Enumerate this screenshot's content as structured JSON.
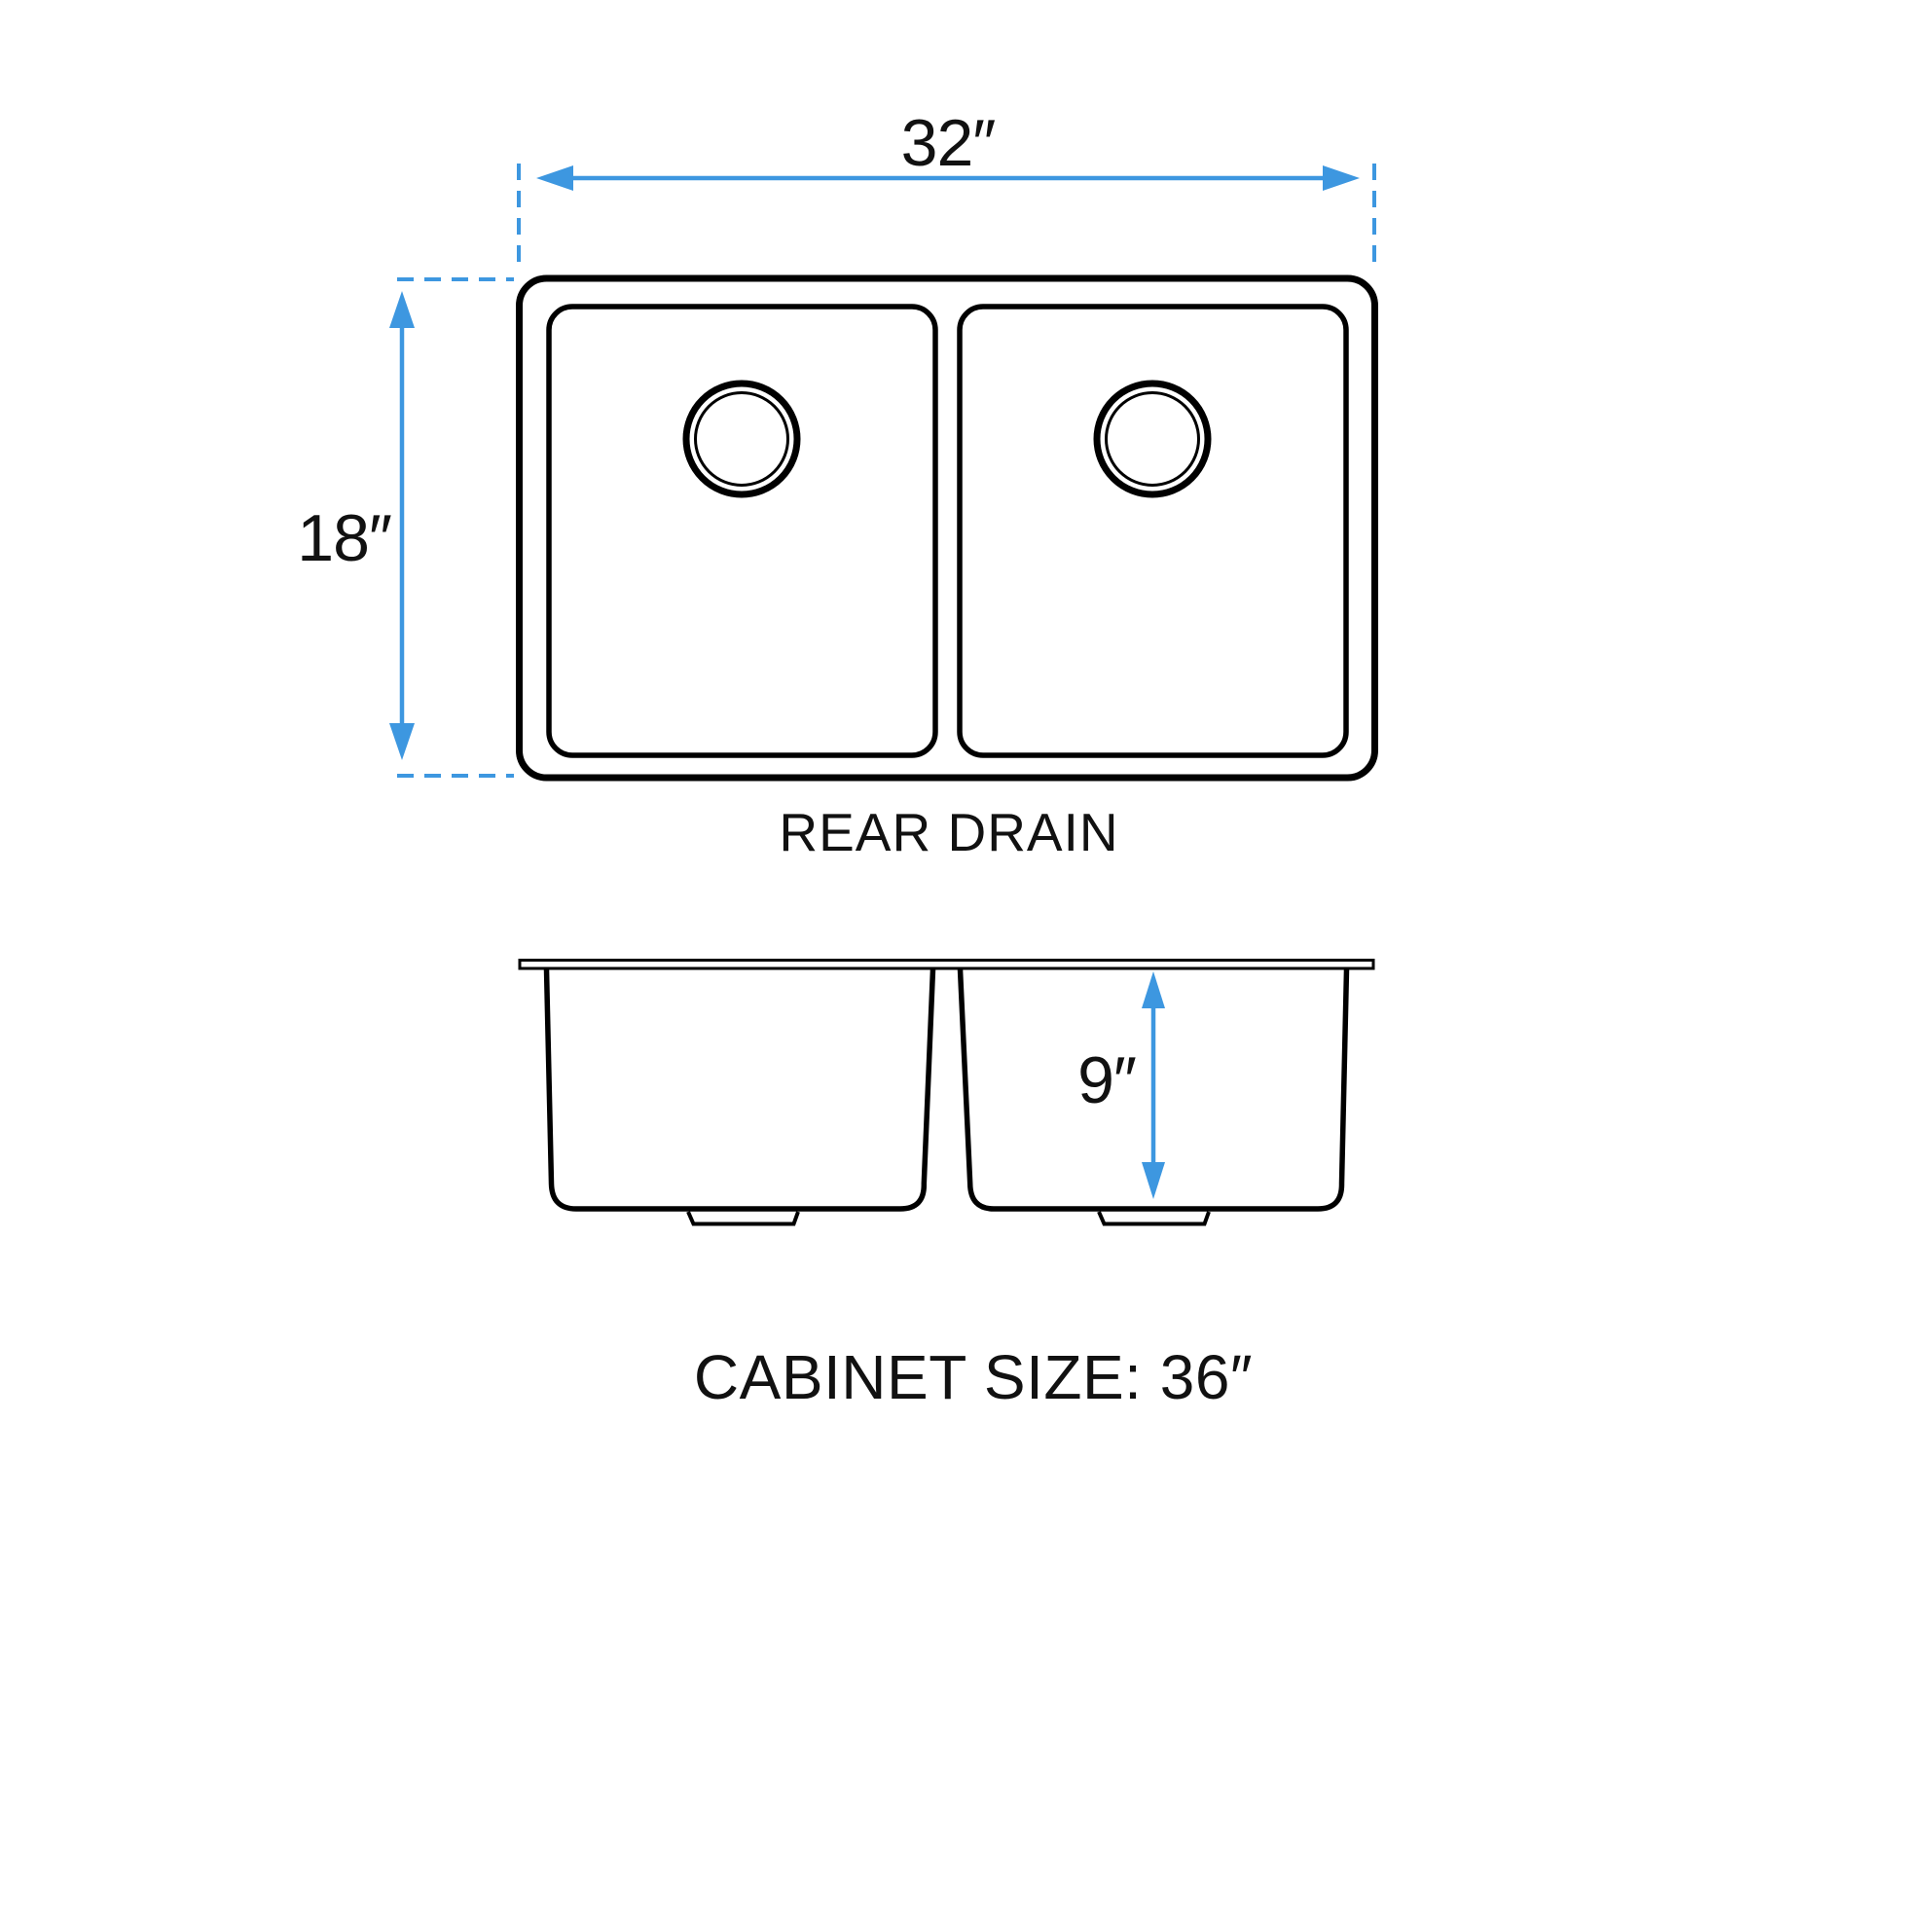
{
  "diagram": {
    "kind": "double-bowl-sink-dimension-drawing",
    "top_view": {
      "width_label": "32″",
      "depth_label": "18″",
      "caption": "REAR DRAIN"
    },
    "side_view": {
      "bowl_depth_label": "9″",
      "caption": "CABINET SIZE: 36″"
    },
    "colors": {
      "outline": "#000000",
      "dimension": "#3D97E0",
      "background": "#FFFFFF"
    }
  }
}
